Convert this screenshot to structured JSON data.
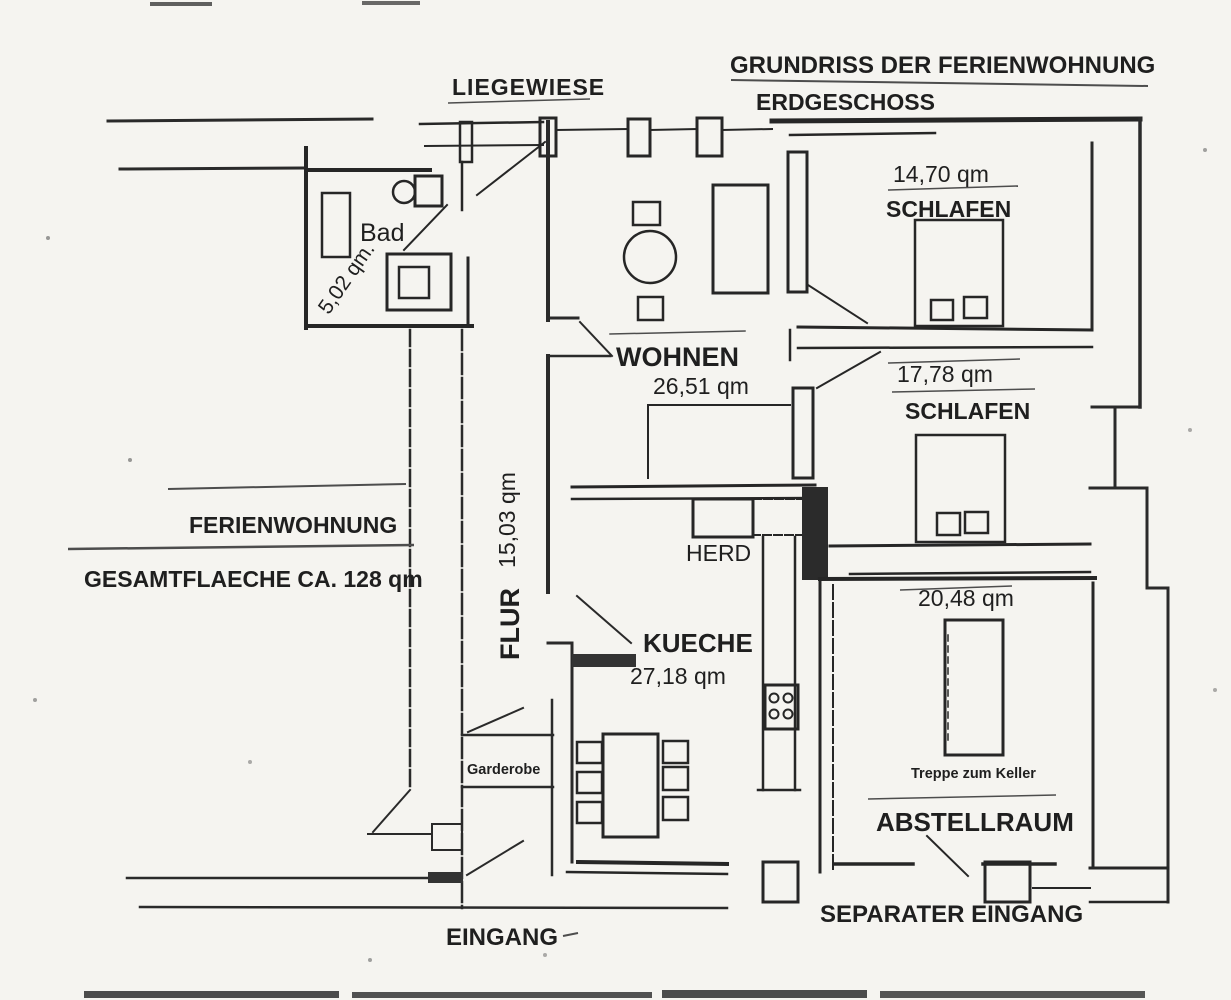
{
  "document": {
    "title_line1": "GRUNDRISS DER FERIENWOHNUNG",
    "title_line2": "ERDGESCHOSS"
  },
  "outdoor": {
    "liegewiese_label": "LIEGEWIESE"
  },
  "summary": {
    "apartment_label": "FERIENWOHNUNG",
    "total_area_label": "GESAMTFLAECHE CA. 128 qm"
  },
  "rooms": {
    "bad": {
      "label": "Bad",
      "area": "5,02 qm."
    },
    "wohnen": {
      "label": "WOHNEN",
      "area": "26,51 qm"
    },
    "schlafen1": {
      "label": "SCHLAFEN",
      "area": "14,70 qm"
    },
    "schlafen2": {
      "label": "SCHLAFEN",
      "area": "17,78 qm"
    },
    "flur": {
      "label": "FLUR",
      "area": "15,03 qm"
    },
    "kueche": {
      "label": "KUECHE",
      "area": "27,18 qm",
      "herd_label": "HERD"
    },
    "abstellraum": {
      "label": "ABSTELLRAUM",
      "area": "20,48 qm",
      "treppe_label": "Treppe zum Keller"
    },
    "garderobe": {
      "label": "Garderobe"
    }
  },
  "entrances": {
    "main": "EINGANG",
    "separate": "SEPARATER  EINGANG"
  },
  "colors": {
    "paper": "#f5f4f0",
    "ink": "#262626",
    "ink_light": "#4d4d4d"
  }
}
